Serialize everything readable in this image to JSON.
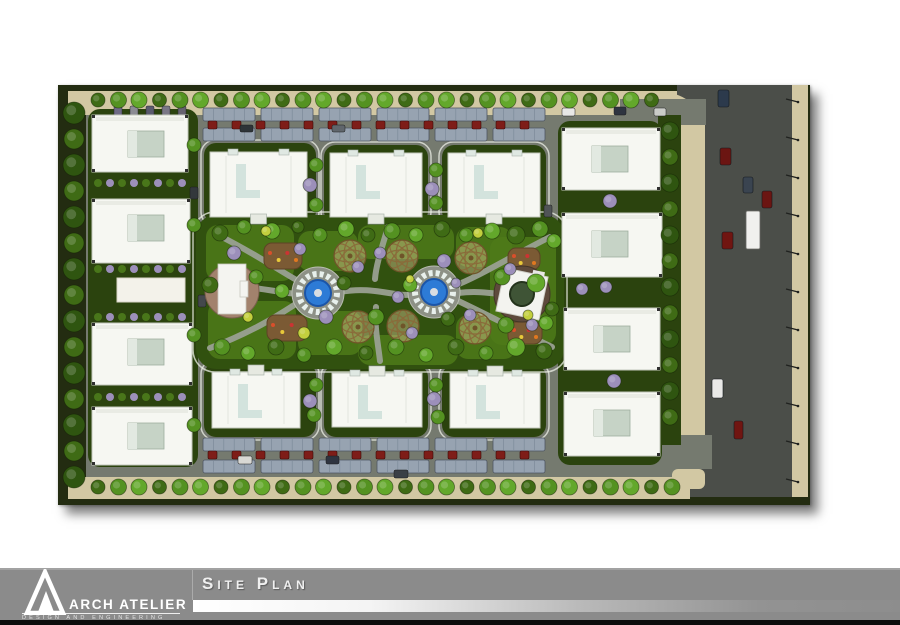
{
  "footer": {
    "title": "Site Plan",
    "logo": {
      "name": "ARCH ATELIER",
      "tagline": "DESIGN AND ENGINEERING"
    },
    "colors": {
      "band": "#8b8b8b",
      "black_strip": "#0c0c0c",
      "text": "#ffffff"
    }
  },
  "plan": {
    "colors": {
      "perimeter_dark": "#232c11",
      "ground_gray": "#757a6f",
      "road_dark": "#4b4e49",
      "sidewalk_beige": "#d2c8a3",
      "lawn_dark": "#2b430e",
      "lawn_light": "#4d7a19",
      "building_white": "#f6f7f2",
      "cube_green": "#c6d3c6",
      "canopy": "#97a3b1",
      "car_red": "#7e1d18",
      "fountain_blue": "#2d7bd6",
      "dome_tan": "#d6c391",
      "path_gray": "#9aa092",
      "pavilion_brown": "#a2826d",
      "pavilion_dark_brown": "#5e4a3c",
      "playground_brown": "#7b5a34",
      "tree_greens": [
        "#3f6b15",
        "#549221",
        "#63a82b",
        "#2f5510"
      ],
      "tree_purple": "#9c8fba",
      "bush_yellow": "#c3cf3e"
    },
    "buildings": {
      "left": [
        {
          "x": 34,
          "y": 30,
          "w": 96,
          "h": 57
        },
        {
          "x": 34,
          "y": 114,
          "w": 98,
          "h": 64
        },
        {
          "x": 34,
          "y": 238,
          "w": 100,
          "h": 62
        },
        {
          "x": 34,
          "y": 322,
          "w": 100,
          "h": 58
        }
      ],
      "right": [
        {
          "x": 504,
          "y": 43,
          "w": 98,
          "h": 62
        },
        {
          "x": 504,
          "y": 128,
          "w": 100,
          "h": 64
        },
        {
          "x": 506,
          "y": 223,
          "w": 96,
          "h": 62
        },
        {
          "x": 506,
          "y": 307,
          "w": 96,
          "h": 64
        }
      ],
      "top": [
        {
          "x": 152,
          "y": 67,
          "w": 97,
          "h": 65
        },
        {
          "x": 272,
          "y": 68,
          "w": 92,
          "h": 64
        },
        {
          "x": 390,
          "y": 68,
          "w": 92,
          "h": 64
        }
      ],
      "bottom": [
        {
          "x": 154,
          "y": 287,
          "w": 88,
          "h": 56
        },
        {
          "x": 274,
          "y": 288,
          "w": 90,
          "h": 54
        },
        {
          "x": 392,
          "y": 288,
          "w": 90,
          "h": 55
        }
      ]
    },
    "court": {
      "x": 59,
      "y": 193,
      "w": 68,
      "h": 24
    },
    "lawns_top": [
      {
        "x": 146,
        "y": 58,
        "w": 112,
        "h": 80
      },
      {
        "x": 266,
        "y": 60,
        "w": 104,
        "h": 78
      },
      {
        "x": 384,
        "y": 60,
        "w": 104,
        "h": 78
      }
    ],
    "lawns_bottom": [
      {
        "x": 146,
        "y": 278,
        "w": 112,
        "h": 74
      },
      {
        "x": 266,
        "y": 280,
        "w": 104,
        "h": 72
      },
      {
        "x": 384,
        "y": 280,
        "w": 104,
        "h": 72
      }
    ],
    "park": {
      "x": 138,
      "y": 130,
      "w": 368,
      "h": 154,
      "lawn_blobs": [
        {
          "x": 148,
          "y": 140,
          "w": 88,
          "h": 56
        },
        {
          "x": 150,
          "y": 216,
          "w": 88,
          "h": 58
        },
        {
          "x": 240,
          "y": 146,
          "w": 60,
          "h": 40
        },
        {
          "x": 240,
          "y": 226,
          "w": 64,
          "h": 44
        },
        {
          "x": 300,
          "y": 140,
          "w": 96,
          "h": 34
        },
        {
          "x": 300,
          "y": 250,
          "w": 100,
          "h": 30
        },
        {
          "x": 398,
          "y": 142,
          "w": 56,
          "h": 40
        },
        {
          "x": 398,
          "y": 230,
          "w": 60,
          "h": 44
        },
        {
          "x": 432,
          "y": 152,
          "w": 66,
          "h": 108
        }
      ],
      "paths": [
        "M150,205 C200,195 230,215 258,207",
        "M282,207 C320,200 340,215 360,208",
        "M400,208 C425,205 438,210 450,209",
        "M160,150 C200,170 228,190 244,198",
        "M152,263 C200,245 228,225 244,215",
        "M492,152 C452,172 420,192 396,201",
        "M494,262 C456,244 422,226 396,214",
        "M330,142 C324,162 318,180 317,194",
        "M318,222 C316,240 320,258 322,276"
      ],
      "fountains": [
        {
          "cx": 260,
          "cy": 208
        },
        {
          "cx": 376,
          "cy": 207
        }
      ],
      "domes": [
        {
          "cx": 292,
          "cy": 171
        },
        {
          "cx": 344,
          "cy": 171
        },
        {
          "cx": 413,
          "cy": 173
        },
        {
          "cx": 300,
          "cy": 242
        },
        {
          "cx": 345,
          "cy": 241
        },
        {
          "cx": 417,
          "cy": 243
        }
      ],
      "pavilion_left": {
        "cx": 174,
        "cy": 206,
        "r": 27
      },
      "pavilion_right": {
        "cx": 464,
        "cy": 209,
        "r": 28
      },
      "playgrounds": [
        {
          "x": 206,
          "y": 158,
          "w": 38,
          "h": 26
        },
        {
          "x": 209,
          "y": 230,
          "w": 40,
          "h": 26
        },
        {
          "x": 450,
          "y": 163,
          "w": 32,
          "h": 22
        },
        {
          "x": 450,
          "y": 237,
          "w": 34,
          "h": 22
        }
      ]
    },
    "canopies": {
      "segment_xs": [
        145,
        203,
        261,
        319,
        377,
        435
      ],
      "segment_w": 52,
      "rows_y": [
        23,
        43,
        353,
        375
      ],
      "h": 13
    },
    "red_car_rows": [
      {
        "y": 36,
        "x0": 150,
        "x1": 466,
        "step": 24
      },
      {
        "y": 366,
        "x0": 150,
        "x1": 466,
        "step": 24
      }
    ],
    "aisle_cars": [
      {
        "x": 182,
        "y": 40,
        "w": 13,
        "h": 7,
        "c": "#2e3438"
      },
      {
        "x": 274,
        "y": 40,
        "w": 13,
        "h": 7,
        "c": "#60666c"
      },
      {
        "x": 504,
        "y": 23,
        "w": 13,
        "h": 8,
        "c": "#e8e8e6"
      },
      {
        "x": 556,
        "y": 22,
        "w": 12,
        "h": 8,
        "c": "#2e3440"
      },
      {
        "x": 596,
        "y": 23,
        "w": 12,
        "h": 8,
        "c": "#caccc8"
      },
      {
        "x": 180,
        "y": 371,
        "w": 14,
        "h": 8,
        "c": "#d8d8d4"
      },
      {
        "x": 268,
        "y": 371,
        "w": 13,
        "h": 8,
        "c": "#2e3440"
      },
      {
        "x": 336,
        "y": 385,
        "w": 14,
        "h": 8,
        "c": "#3a4046"
      }
    ],
    "inner_cars": [
      {
        "x": 132,
        "y": 102,
        "w": 8,
        "h": 12,
        "c": "#33383c"
      },
      {
        "x": 140,
        "y": 210,
        "w": 8,
        "h": 12,
        "c": "#44484c"
      },
      {
        "x": 486,
        "y": 120,
        "w": 8,
        "h": 12,
        "c": "#505456"
      }
    ],
    "parking_cars_topleft": [
      {
        "x": 56,
        "c": "#6e6a85"
      },
      {
        "x": 72,
        "c": "#8b8b93"
      },
      {
        "x": 88,
        "c": "#5a5a6e"
      },
      {
        "x": 104,
        "c": "#7a7786"
      },
      {
        "x": 120,
        "c": "#66626f"
      }
    ],
    "road": {
      "junction_top": {
        "x": 562,
        "y": 14,
        "w": 86,
        "h": 26
      },
      "junction_bottom": {
        "x": 576,
        "y": 350,
        "w": 78,
        "h": 34
      },
      "cars": [
        {
          "x": 660,
          "y": 5,
          "w": 11,
          "h": 17,
          "c": "#2c3a4c"
        },
        {
          "x": 662,
          "y": 63,
          "w": 11,
          "h": 17,
          "c": "#6b1512"
        },
        {
          "x": 685,
          "y": 92,
          "w": 10,
          "h": 16,
          "c": "#3a4450"
        },
        {
          "x": 704,
          "y": 106,
          "w": 10,
          "h": 17,
          "c": "#6b1512"
        },
        {
          "x": 664,
          "y": 147,
          "w": 11,
          "h": 17,
          "c": "#701511"
        },
        {
          "x": 654,
          "y": 294,
          "w": 11,
          "h": 19,
          "c": "#e9e9e7"
        },
        {
          "x": 676,
          "y": 336,
          "w": 9,
          "h": 18,
          "c": "#701511"
        }
      ],
      "bus": {
        "x": 688,
        "y": 126,
        "w": 14,
        "h": 38,
        "c": "#f0f0ee"
      },
      "pole_ys": [
        14,
        52,
        90,
        128,
        166,
        204,
        242,
        280,
        318,
        356,
        394
      ]
    },
    "trees": {
      "top_row": {
        "y": 15,
        "x0": 40,
        "x1": 604,
        "step": 20.5,
        "r": 8
      },
      "bottom_row": {
        "y": 402,
        "x0": 40,
        "x1": 614,
        "step": 20.5,
        "r": 8
      },
      "left_strip": {
        "x": 16,
        "y0": 28,
        "y1": 398,
        "step": 26,
        "r": 11
      },
      "right_strip": {
        "x": 612,
        "y0": 46,
        "y1": 350,
        "step": 26,
        "r": 9
      },
      "park_green": [
        [
          162,
          148,
          8
        ],
        [
          186,
          142,
          7
        ],
        [
          214,
          146,
          8
        ],
        [
          240,
          142,
          6
        ],
        [
          262,
          150,
          7
        ],
        [
          288,
          144,
          8
        ],
        [
          310,
          150,
          7
        ],
        [
          334,
          146,
          8
        ],
        [
          358,
          150,
          7
        ],
        [
          384,
          144,
          8
        ],
        [
          408,
          150,
          7
        ],
        [
          434,
          146,
          8
        ],
        [
          458,
          150,
          9
        ],
        [
          482,
          144,
          8
        ],
        [
          496,
          156,
          7
        ],
        [
          152,
          200,
          8
        ],
        [
          198,
          192,
          7
        ],
        [
          224,
          206,
          7
        ],
        [
          286,
          198,
          7
        ],
        [
          318,
          232,
          8
        ],
        [
          352,
          200,
          7
        ],
        [
          390,
          234,
          7
        ],
        [
          444,
          192,
          8
        ],
        [
          478,
          198,
          9
        ],
        [
          494,
          224,
          7
        ],
        [
          164,
          262,
          8
        ],
        [
          190,
          268,
          7
        ],
        [
          218,
          262,
          8
        ],
        [
          246,
          270,
          7
        ],
        [
          276,
          262,
          8
        ],
        [
          308,
          268,
          7
        ],
        [
          338,
          262,
          8
        ],
        [
          368,
          270,
          7
        ],
        [
          398,
          262,
          8
        ],
        [
          428,
          268,
          7
        ],
        [
          458,
          262,
          9
        ],
        [
          486,
          266,
          8
        ],
        [
          448,
          240,
          8
        ],
        [
          488,
          238,
          7
        ]
      ],
      "park_purple": [
        [
          176,
          168,
          7
        ],
        [
          242,
          164,
          6
        ],
        [
          268,
          232,
          7
        ],
        [
          300,
          182,
          6
        ],
        [
          340,
          212,
          6
        ],
        [
          386,
          176,
          7
        ],
        [
          412,
          230,
          6
        ],
        [
          452,
          184,
          6
        ],
        [
          474,
          240,
          6
        ],
        [
          354,
          248,
          6
        ],
        [
          322,
          168,
          6
        ],
        [
          398,
          198,
          5
        ]
      ],
      "park_yellow": [
        [
          190,
          232,
          5
        ],
        [
          246,
          248,
          6
        ],
        [
          420,
          148,
          5
        ],
        [
          470,
          230,
          5
        ],
        [
          352,
          194,
          4
        ],
        [
          208,
          146,
          5
        ]
      ],
      "between_tops": [
        [
          258,
          80,
          7
        ],
        [
          258,
          120,
          7
        ],
        [
          378,
          85,
          7
        ],
        [
          378,
          118,
          7
        ],
        [
          136,
          60,
          7
        ],
        [
          136,
          140,
          7
        ],
        [
          136,
          250,
          7
        ],
        [
          136,
          340,
          7
        ]
      ],
      "between_bottoms": [
        [
          258,
          300,
          7
        ],
        [
          256,
          330,
          7
        ],
        [
          378,
          300,
          7
        ],
        [
          380,
          332,
          7
        ]
      ],
      "purple_cols": [
        [
          252,
          100,
          7
        ],
        [
          374,
          104,
          7
        ],
        [
          252,
          316,
          7
        ],
        [
          376,
          314,
          7
        ],
        [
          552,
          116,
          7
        ],
        [
          524,
          204,
          6
        ],
        [
          548,
          202,
          6
        ],
        [
          556,
          296,
          7
        ]
      ],
      "shrub_rows_y": [
        98,
        184,
        232,
        312
      ]
    }
  }
}
